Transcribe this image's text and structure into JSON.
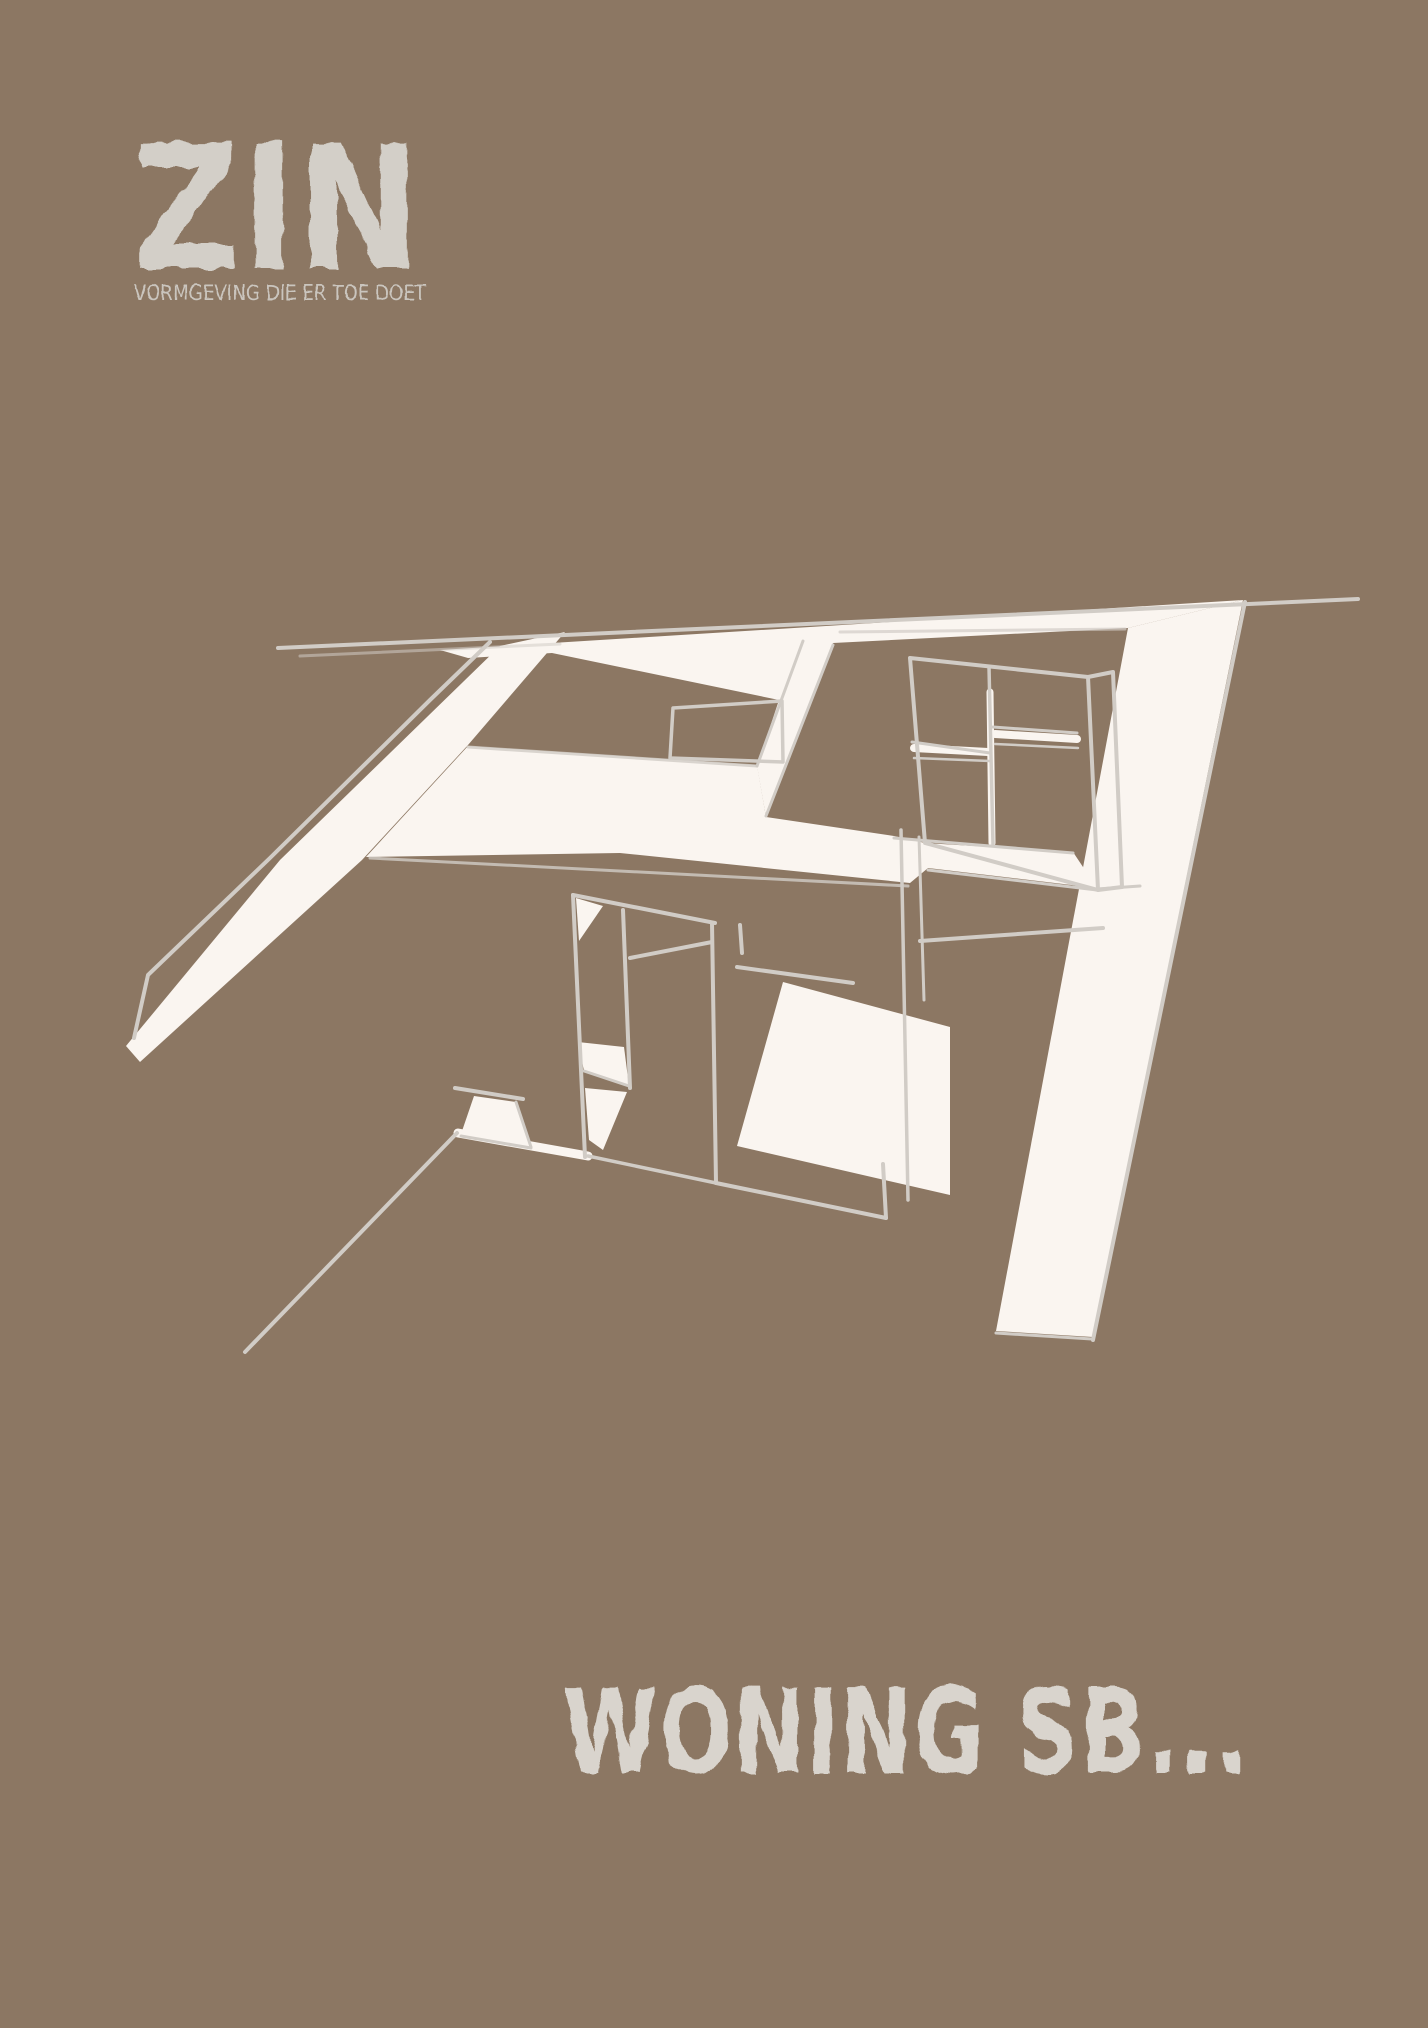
{
  "colors": {
    "background": "#8c7763",
    "sketch_white": "#faf5f0",
    "sketch_line": "#d1ccc6",
    "logo": "#d3cfc8",
    "tagline": "#cac5be",
    "title": "#d9d4cd"
  },
  "logo": {
    "text": "ZIN",
    "tagline": "VORMGEVING DIE ER TOE DOET"
  },
  "title": {
    "text": "WONING SB..."
  },
  "sketch": {
    "name": "attic-interior-sketch"
  }
}
